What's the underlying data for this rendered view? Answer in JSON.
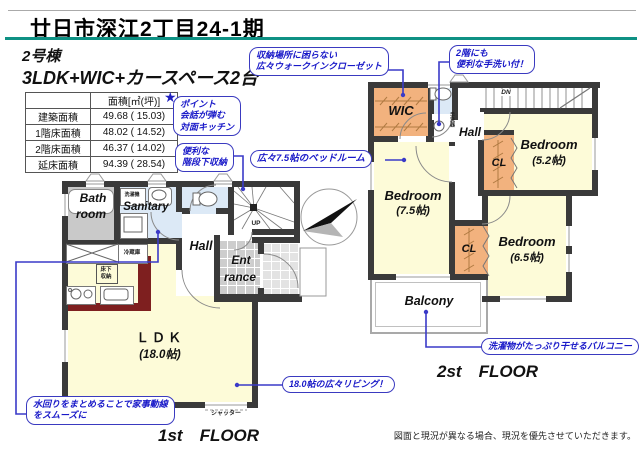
{
  "header": {
    "title": "廿日市深江2丁目24-1期",
    "building_no": "2号棟",
    "layout": "3LDK+WIC+カースペース2台"
  },
  "area_table": {
    "unit_header": "面積[㎡(坪)]",
    "rows": [
      {
        "label": "建築面積",
        "value": "49.68 ( 15.03)"
      },
      {
        "label": "1階床面積",
        "value": "48.02 ( 14.52)"
      },
      {
        "label": "2階床面積",
        "value": "46.37 ( 14.02)"
      },
      {
        "label": "延床面積",
        "value": "94.39 ( 28.54)"
      }
    ]
  },
  "callouts": {
    "wic": {
      "line1": "収納場所に困らない",
      "line2": "広々ウォークインクローゼット"
    },
    "handwash": {
      "line1": "2階にも",
      "line2": "便利な手洗い付！"
    },
    "kitchen": {
      "star": "★",
      "line1": "ポイント",
      "line2": "会話が弾む",
      "line3": "対面キッチン"
    },
    "stair_storage": {
      "line1": "便利な",
      "line2": "階段下収納"
    },
    "bedroom75": "広々7.5帖のベッドルーム",
    "living": "18.0帖の広々リビング！",
    "water": {
      "line1": "水回りをまとめることで家事動線",
      "line2": "をスムーズに"
    },
    "balcony": "洗濯物がたっぷり干せるバルコニー"
  },
  "floor1": {
    "caption": "1st　FLOOR",
    "rooms": {
      "bath_line1": "Bath",
      "bath_line2": "room",
      "sanitary": "Sanitary",
      "hall": "Hall",
      "entrance_line1": "Ent",
      "entrance_line2": "rance",
      "ldk_line1": "ＬＤＫ",
      "ldk_line2": "(18.0帖)"
    },
    "labels": {
      "washer": "洗濯機",
      "fridge": "冷蔵庫",
      "underfloor_line1": "床下",
      "underfloor_line2": "収納",
      "up": "UP",
      "shutter": "シャッター"
    }
  },
  "floor2": {
    "caption": "2st　FLOOR",
    "rooms": {
      "wic": "WIC",
      "hall": "Hall",
      "bedroom75_line1": "Bedroom",
      "bedroom75_line2": "(7.5帖)",
      "bedroom52_line1": "Bedroom",
      "bedroom52_line2": "(5.2帖)",
      "bedroom65_line1": "Bedroom",
      "bedroom65_line2": "(6.5帖)",
      "cl": "CL",
      "balcony": "Balcony"
    },
    "labels": {
      "dn": "DN",
      "handwash_basin": "手洗器"
    }
  },
  "footer": {
    "disclaimer": "図面と現況が異なる場合、現況を優先させていただきます。"
  },
  "colors": {
    "accent_teal": "#0e9184",
    "callout_blue": "#2222bb",
    "wall": "#3a3a3a",
    "room_yellow": "#fdfbd8",
    "closet_orange": "#f2b27e",
    "wet_blue": "#dce9f6",
    "counter_red": "#7e1f1f"
  }
}
